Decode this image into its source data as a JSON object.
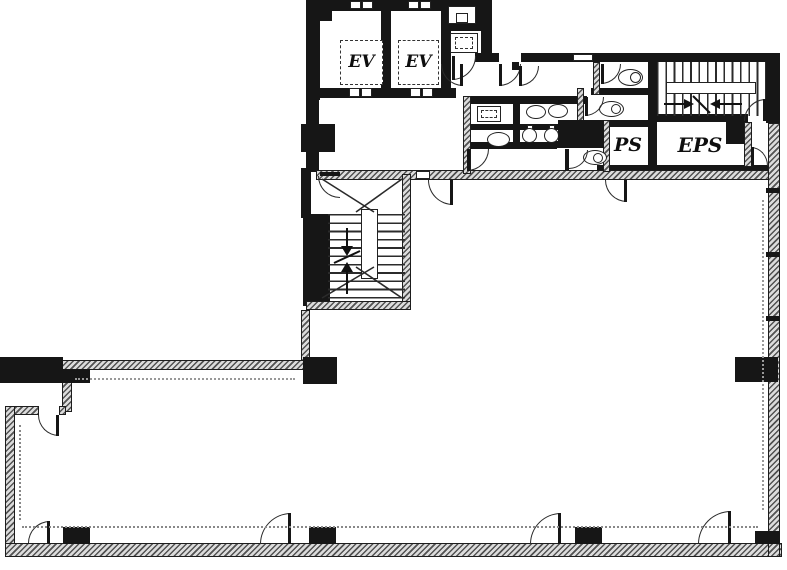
{
  "document": {
    "type": "architectural floor plan",
    "style": "black and white scanned office-building floor plan"
  },
  "labels": {
    "ev1": "EV",
    "ev2": "EV",
    "ps": "PS",
    "eps": "EPS"
  },
  "colors": {
    "wall": "#161616",
    "background": "#ffffff",
    "hatch_dark": "#525252",
    "hatch_light": "#dcdcdc"
  },
  "features": {
    "elevators": 2,
    "stairwells": 2,
    "toilet_rooms": 3,
    "wash_basins": 3,
    "urinals": 2,
    "door_swings": 18,
    "structural_columns": 8
  }
}
